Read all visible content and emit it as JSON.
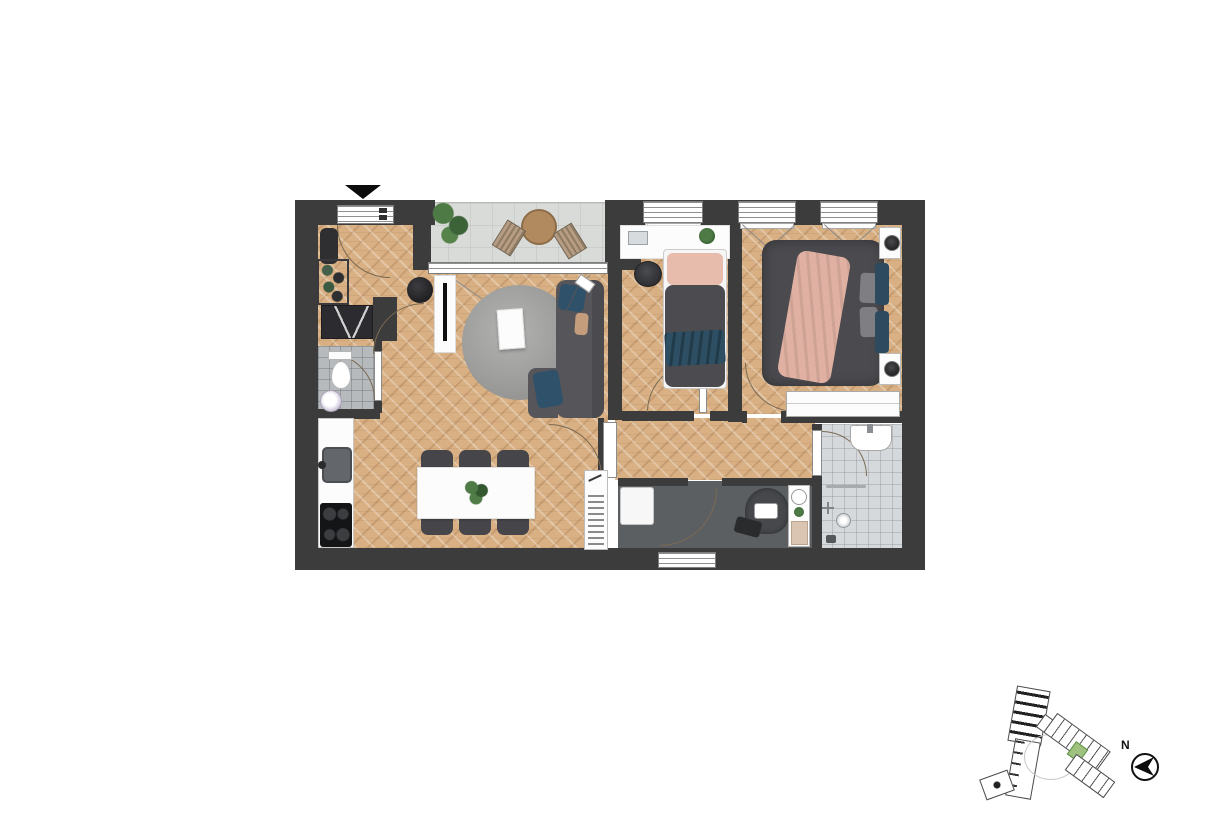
{
  "compass": {
    "label": "N"
  },
  "colors": {
    "wall": "#3c3c3c",
    "wood_floor": "#d8b083",
    "balcony_floor": "#d9dbd8",
    "wc_tile": "#b6babd",
    "bathroom_tile": "#d5d9dc",
    "utility_floor": "#5c5f62",
    "sofa_gray": "#56565a",
    "bed_duvet": "#4b4b4f",
    "accent_blue": "#2e4f63",
    "accent_pink": "#e2b1a4",
    "rug_gray": "#a4a4a2",
    "site_highlight": "#9fc27e"
  },
  "floor_plan": {
    "rooms": [
      {
        "name": "entrance-hall"
      },
      {
        "name": "wc"
      },
      {
        "name": "kitchen-dining"
      },
      {
        "name": "living-room"
      },
      {
        "name": "balcony"
      },
      {
        "name": "bedroom-small"
      },
      {
        "name": "bedroom-master"
      },
      {
        "name": "hallway"
      },
      {
        "name": "utility-room"
      },
      {
        "name": "bathroom"
      }
    ]
  },
  "site_plan": {
    "highlighted_unit": "apartment-location"
  }
}
